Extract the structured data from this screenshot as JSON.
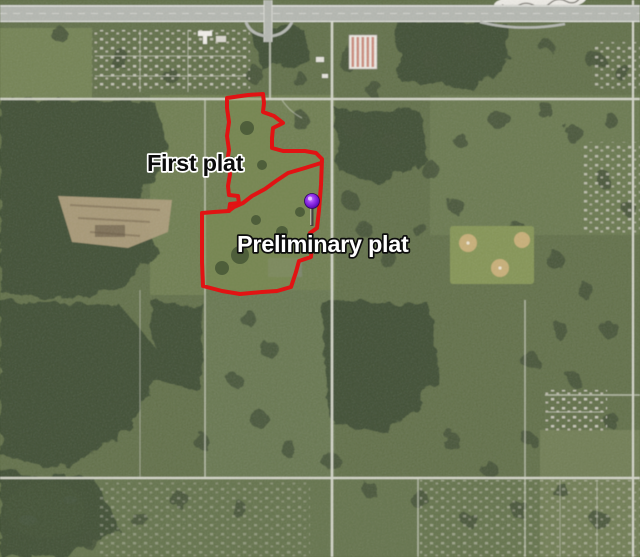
{
  "labels": {
    "first_plat": "First plat",
    "preliminary_plat": "Preliminary plat"
  },
  "overlay": {
    "boundary_color": "#e11313",
    "pin_head_color": "#7b22d8",
    "pin_stem_color": "#44423f",
    "outer_path": "M227,98 L248,95 L263,94 L264,103 L263,112 L274,116 L283,123 L273,128 L272,138 L272,148 L283,151 L305,151 L316,153 L322,159 L321,185 L319,210 L317,228 L310,233 L312,245 L311,257 L299,261 L296,272 L291,287 L277,291 L262,292 L240,294 L222,291 L203,286 L202,262 L202,235 L202,213 L214,212 L229,211 L230,204 L239,203 L238,196 L229,195 L228,186 L230,174 L227,163 L229,150 L227,136 L229,122 L227,108 Z",
    "divider_points": "321,163 305,168 288,173 276,181 265,189 252,196 243,203 234,207 230,210",
    "pin_transform": "translate(312,201)"
  },
  "colors": {
    "map_base": "#5c6b42",
    "forest": "#36452b",
    "road": "#d6d8ca",
    "highway": "#b4b7b0"
  }
}
